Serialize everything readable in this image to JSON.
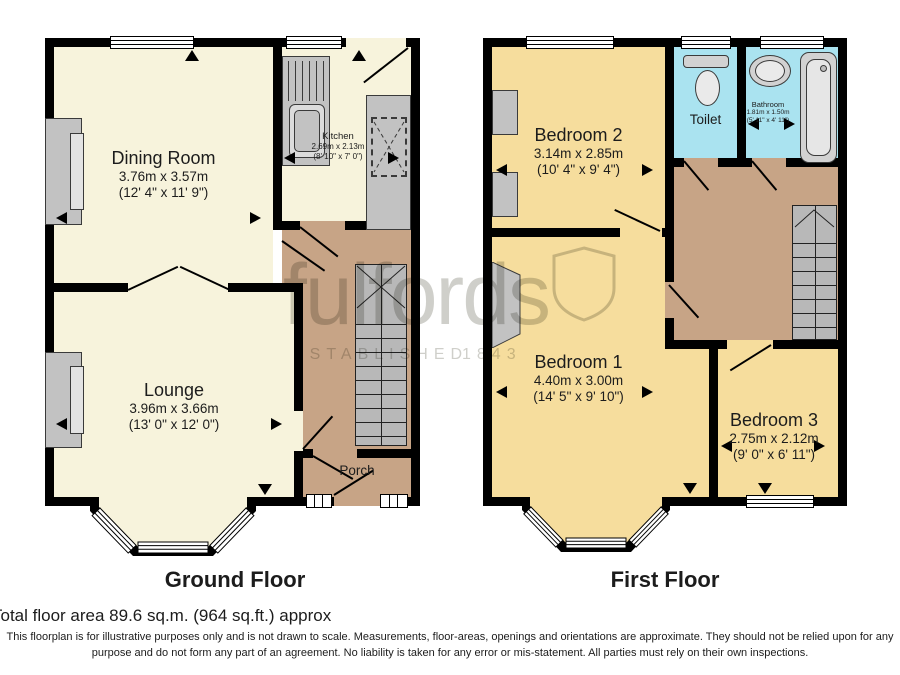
{
  "watermark": {
    "brand": "fulfords",
    "established": "ESTABLISHED",
    "year": "1843"
  },
  "ground_floor": {
    "label": "Ground Floor",
    "dining": {
      "name": "Dining Room",
      "metric": "3.76m x 3.57m",
      "imperial": "(12' 4\" x 11' 9\")"
    },
    "kitchen": {
      "name": "Kitchen",
      "metric": "2.69m x 2.13m",
      "imperial": "(8' 10\" x 7' 0\")"
    },
    "lounge": {
      "name": "Lounge",
      "metric": "3.96m x 3.66m",
      "imperial": "(13' 0\" x 12' 0\")"
    },
    "porch": {
      "name": "Porch"
    }
  },
  "first_floor": {
    "label": "First Floor",
    "bedroom1": {
      "name": "Bedroom 1",
      "metric": "4.40m x 3.00m",
      "imperial": "(14' 5\" x 9' 10\")"
    },
    "bedroom2": {
      "name": "Bedroom 2",
      "metric": "3.14m x 2.85m",
      "imperial": "(10' 4\" x 9' 4\")"
    },
    "bedroom3": {
      "name": "Bedroom 3",
      "metric": "2.75m x 2.12m",
      "imperial": "(9' 0\" x 6' 11\")"
    },
    "toilet": {
      "name": "Toilet"
    },
    "bathroom": {
      "name": "Bathroom",
      "metric": "1.81m x 1.50m",
      "imperial": "(5' 11\" x 4' 11\")"
    }
  },
  "footer": {
    "total_area": "Total floor area 89.6 sq.m. (964 sq.ft.) approx",
    "disclaimer1": "This floorplan is for illustrative purposes only and is not drawn to scale. Measurements, floor-areas, openings and orientations are approximate. They should not be relied upon for any",
    "disclaimer2": "purpose and do not form any part of an agreement. No liability is taken for any error or mis-statement. All parties must rely on their own inspections."
  },
  "colors": {
    "ground_room": "#f7f3dc",
    "bedroom": "#f6dd9d",
    "bathroom": "#aae3f0",
    "hall": "#c7a486",
    "wall": "#000000",
    "fixture": "#c2c2c2"
  }
}
